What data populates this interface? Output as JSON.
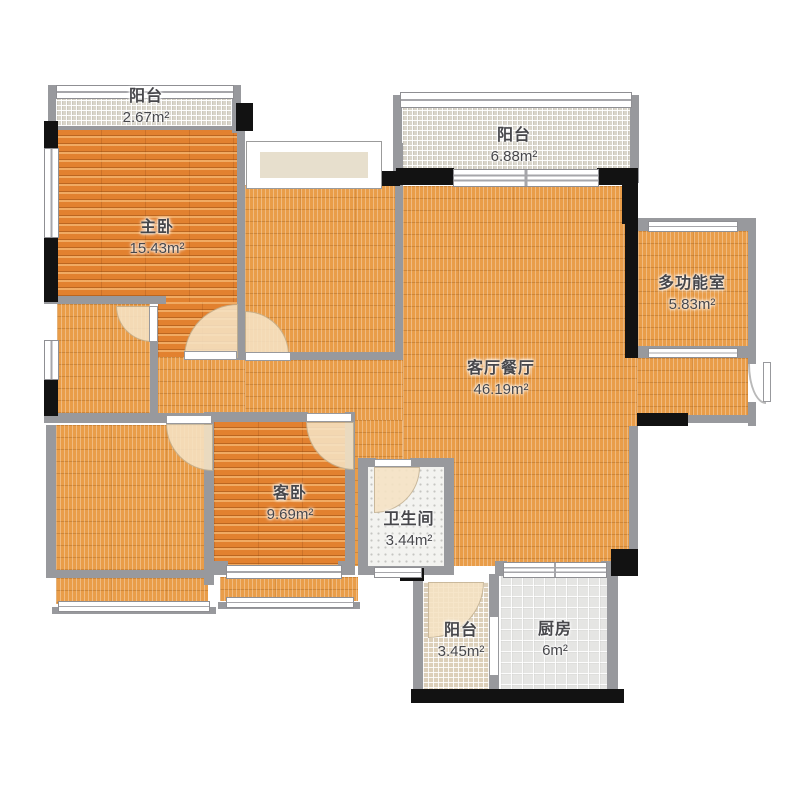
{
  "floorplan": {
    "title": "户型图",
    "unit": "m²",
    "rooms": [
      {
        "id": "balcony-top-left",
        "name": "阳台",
        "area": "2.67m²"
      },
      {
        "id": "master-bedroom",
        "name": "主卧",
        "area": "15.43m²"
      },
      {
        "id": "balcony-top",
        "name": "阳台",
        "area": "6.88m²"
      },
      {
        "id": "multi-function-room",
        "name": "多功能室",
        "area": "5.83m²"
      },
      {
        "id": "living-dining-room",
        "name": "客厅餐厅",
        "area": "46.19m²"
      },
      {
        "id": "guest-bedroom",
        "name": "客卧",
        "area": "9.69m²"
      },
      {
        "id": "bathroom",
        "name": "卫生间",
        "area": "3.44m²"
      },
      {
        "id": "balcony-bottom",
        "name": "阳台",
        "area": "3.45m²"
      },
      {
        "id": "kitchen",
        "name": "厨房",
        "area": "6m²"
      }
    ],
    "colors": {
      "wall_gray": "#98999d",
      "wall_black": "#121212",
      "floor_orange": "#e99d49",
      "wood_orange": "#e2812f",
      "balcony_gray": "#d9d5ca",
      "balcony_beige": "#dccfb9",
      "kitchen_gray": "#e5e5e3",
      "bathroom_white": "#f3f3f0",
      "door_arc": "#f6e3c4",
      "label_text": "#47474b"
    }
  }
}
